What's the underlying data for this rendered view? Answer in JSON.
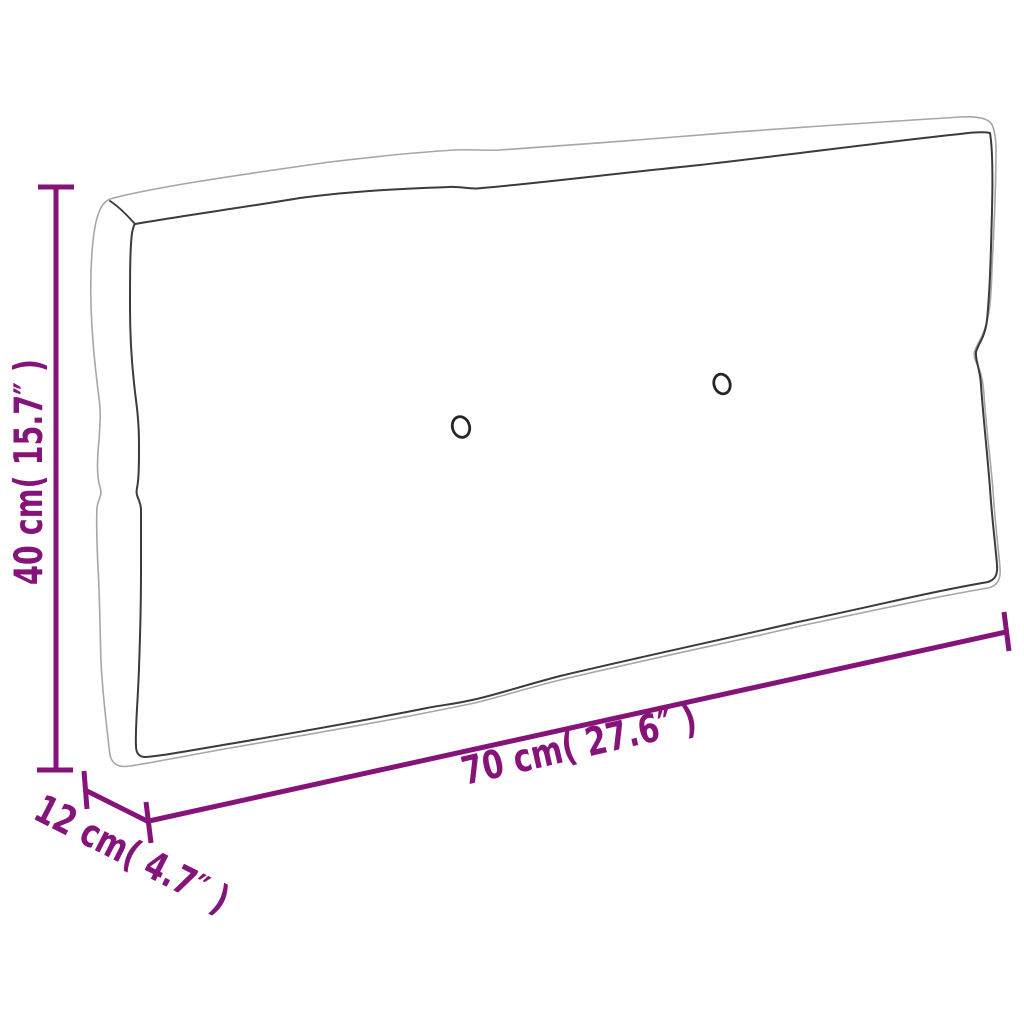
{
  "diagram": {
    "type": "product-dimension-diagram",
    "product": "pallet cushion",
    "background": "#ffffff",
    "colors": {
      "dimension": "#851379",
      "seam": "#3b3b3b",
      "silhouette": "#a6a6a6",
      "button": "#262626"
    },
    "dimensions": {
      "height": {
        "label": "40 cm( 15.7″ )",
        "cm": "40",
        "inches": "15.7"
      },
      "depth": {
        "label": "12 cm( 4.7″ )",
        "cm": "12",
        "inches": "4.7"
      },
      "width": {
        "label": "70 cm( 27.6″ )",
        "cm": "70",
        "inches": "27.6"
      }
    },
    "button_count": 2
  }
}
